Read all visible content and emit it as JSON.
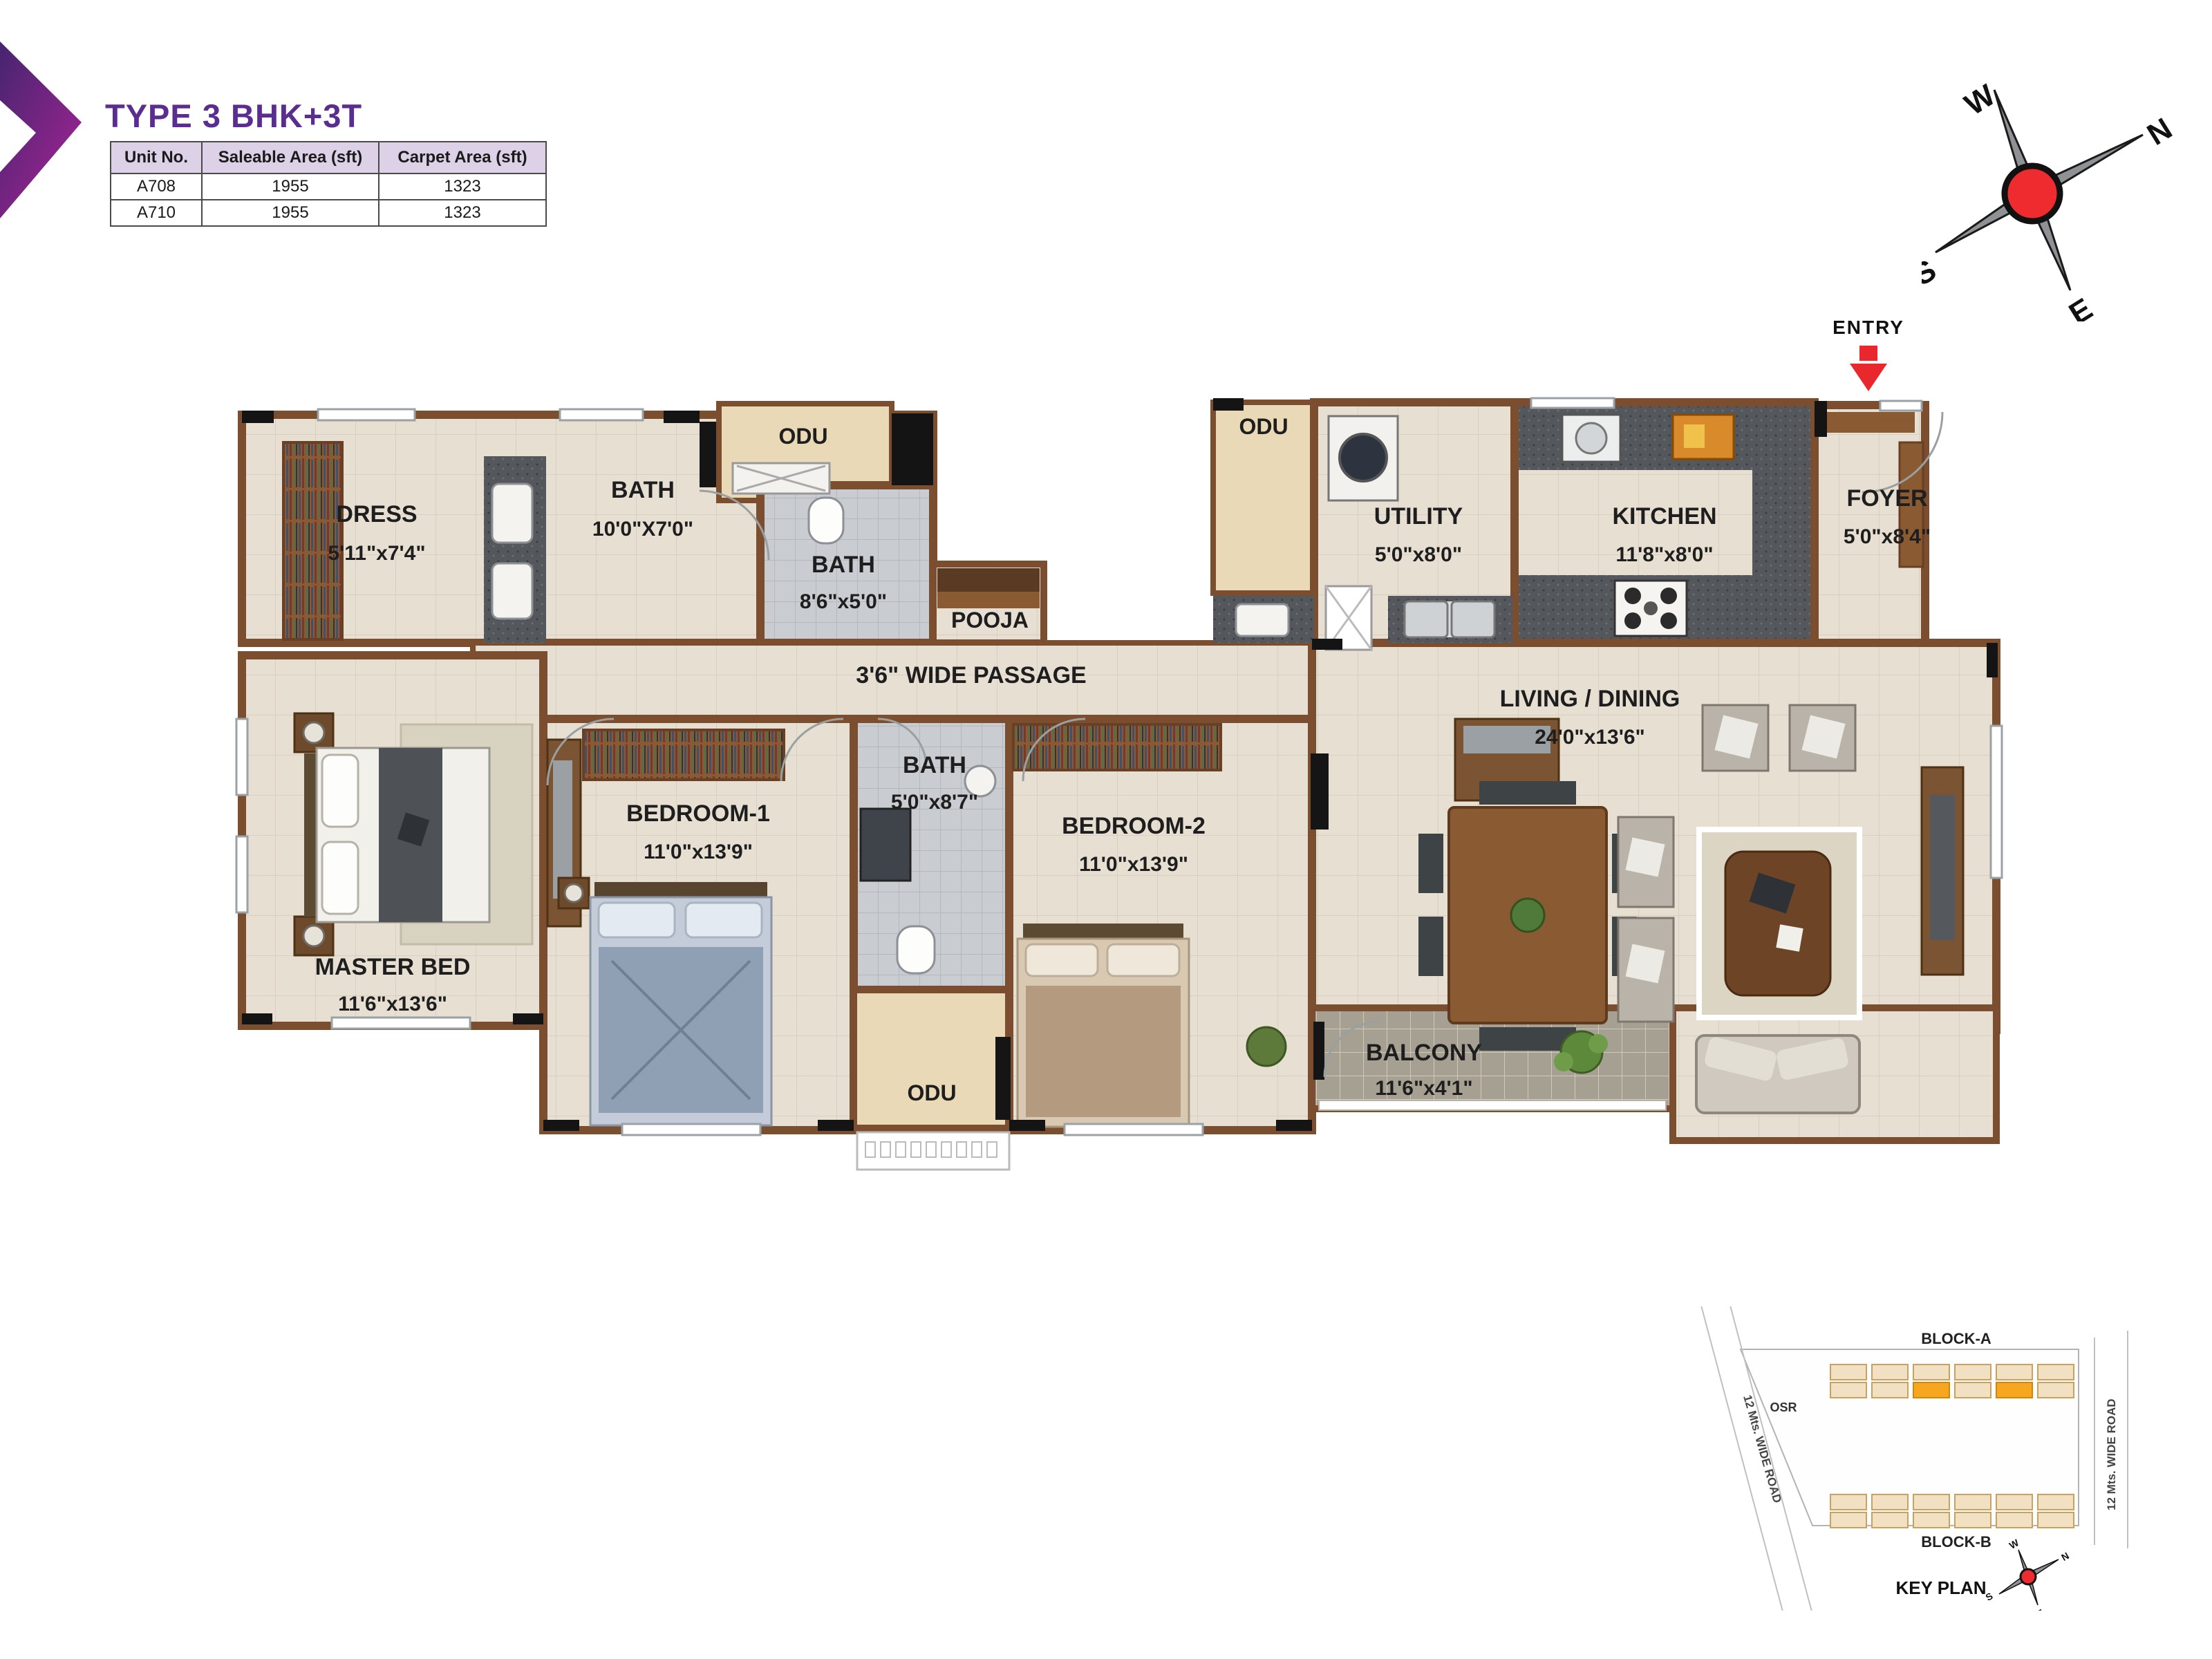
{
  "header": {
    "title": "TYPE 3 BHK+3T",
    "table": {
      "columns": [
        "Unit No.",
        "Saleable Area (sft)",
        "Carpet Area (sft)"
      ],
      "rows": [
        [
          "A708",
          "1955",
          "1323"
        ],
        [
          "A710",
          "1955",
          "1323"
        ]
      ]
    }
  },
  "entry": {
    "label": "ENTRY"
  },
  "compass": {
    "w": "W",
    "n": "N",
    "s": "S",
    "e": "E"
  },
  "rooms": {
    "dress": {
      "name": "DRESS",
      "dims": "5'11\"x7'4\""
    },
    "bath1": {
      "name": "BATH",
      "dims": "10'0\"X7'0\""
    },
    "odu_top": {
      "name": "ODU"
    },
    "bath2": {
      "name": "BATH",
      "dims": "8'6\"x5'0\""
    },
    "pooja": {
      "name": "POOJA"
    },
    "passage": {
      "name": "3'6\" WIDE PASSAGE"
    },
    "odu_right": {
      "name": "ODU"
    },
    "utility": {
      "name": "UTILITY",
      "dims": "5'0\"x8'0\""
    },
    "kitchen": {
      "name": "KITCHEN",
      "dims": "11'8\"x8'0\""
    },
    "foyer": {
      "name": "FOYER",
      "dims": "5'0\"x8'4\""
    },
    "master": {
      "name": "MASTER BED",
      "dims": "11'6\"x13'6\""
    },
    "bedroom1": {
      "name": "BEDROOM-1",
      "dims": "11'0\"x13'9\""
    },
    "bath3": {
      "name": "BATH",
      "dims": "5'0\"x8'7\""
    },
    "bedroom2": {
      "name": "BEDROOM-2",
      "dims": "11'0\"x13'9\""
    },
    "odu_bottom": {
      "name": "ODU"
    },
    "living": {
      "name": "LIVING / DINING",
      "dims": "24'0\"x13'6\""
    },
    "balcony": {
      "name": "BALCONY",
      "dims": "11'6\"x4'1\""
    }
  },
  "keyplan": {
    "block_a": "BLOCK-A",
    "block_b": "BLOCK-B",
    "osr": "OSR",
    "road_left": "12 Mts. WIDE ROAD",
    "road_right": "12 Mts. WIDE ROAD",
    "title": "KEY PLAN",
    "compass": {
      "w": "W",
      "n": "N",
      "s": "S",
      "e": "E"
    }
  },
  "colors": {
    "accent_purple": "#5c2d91",
    "wall_brown": "#7a4e2e",
    "floor_beige": "#e7dfd2",
    "bath_gray": "#c9ccd0",
    "odu_tan": "#ead9b6",
    "balcony_gray": "#a6a093",
    "counter_dark": "#54575b",
    "entry_red": "#e8282d",
    "keyplan_highlight": "#f6a71f"
  }
}
